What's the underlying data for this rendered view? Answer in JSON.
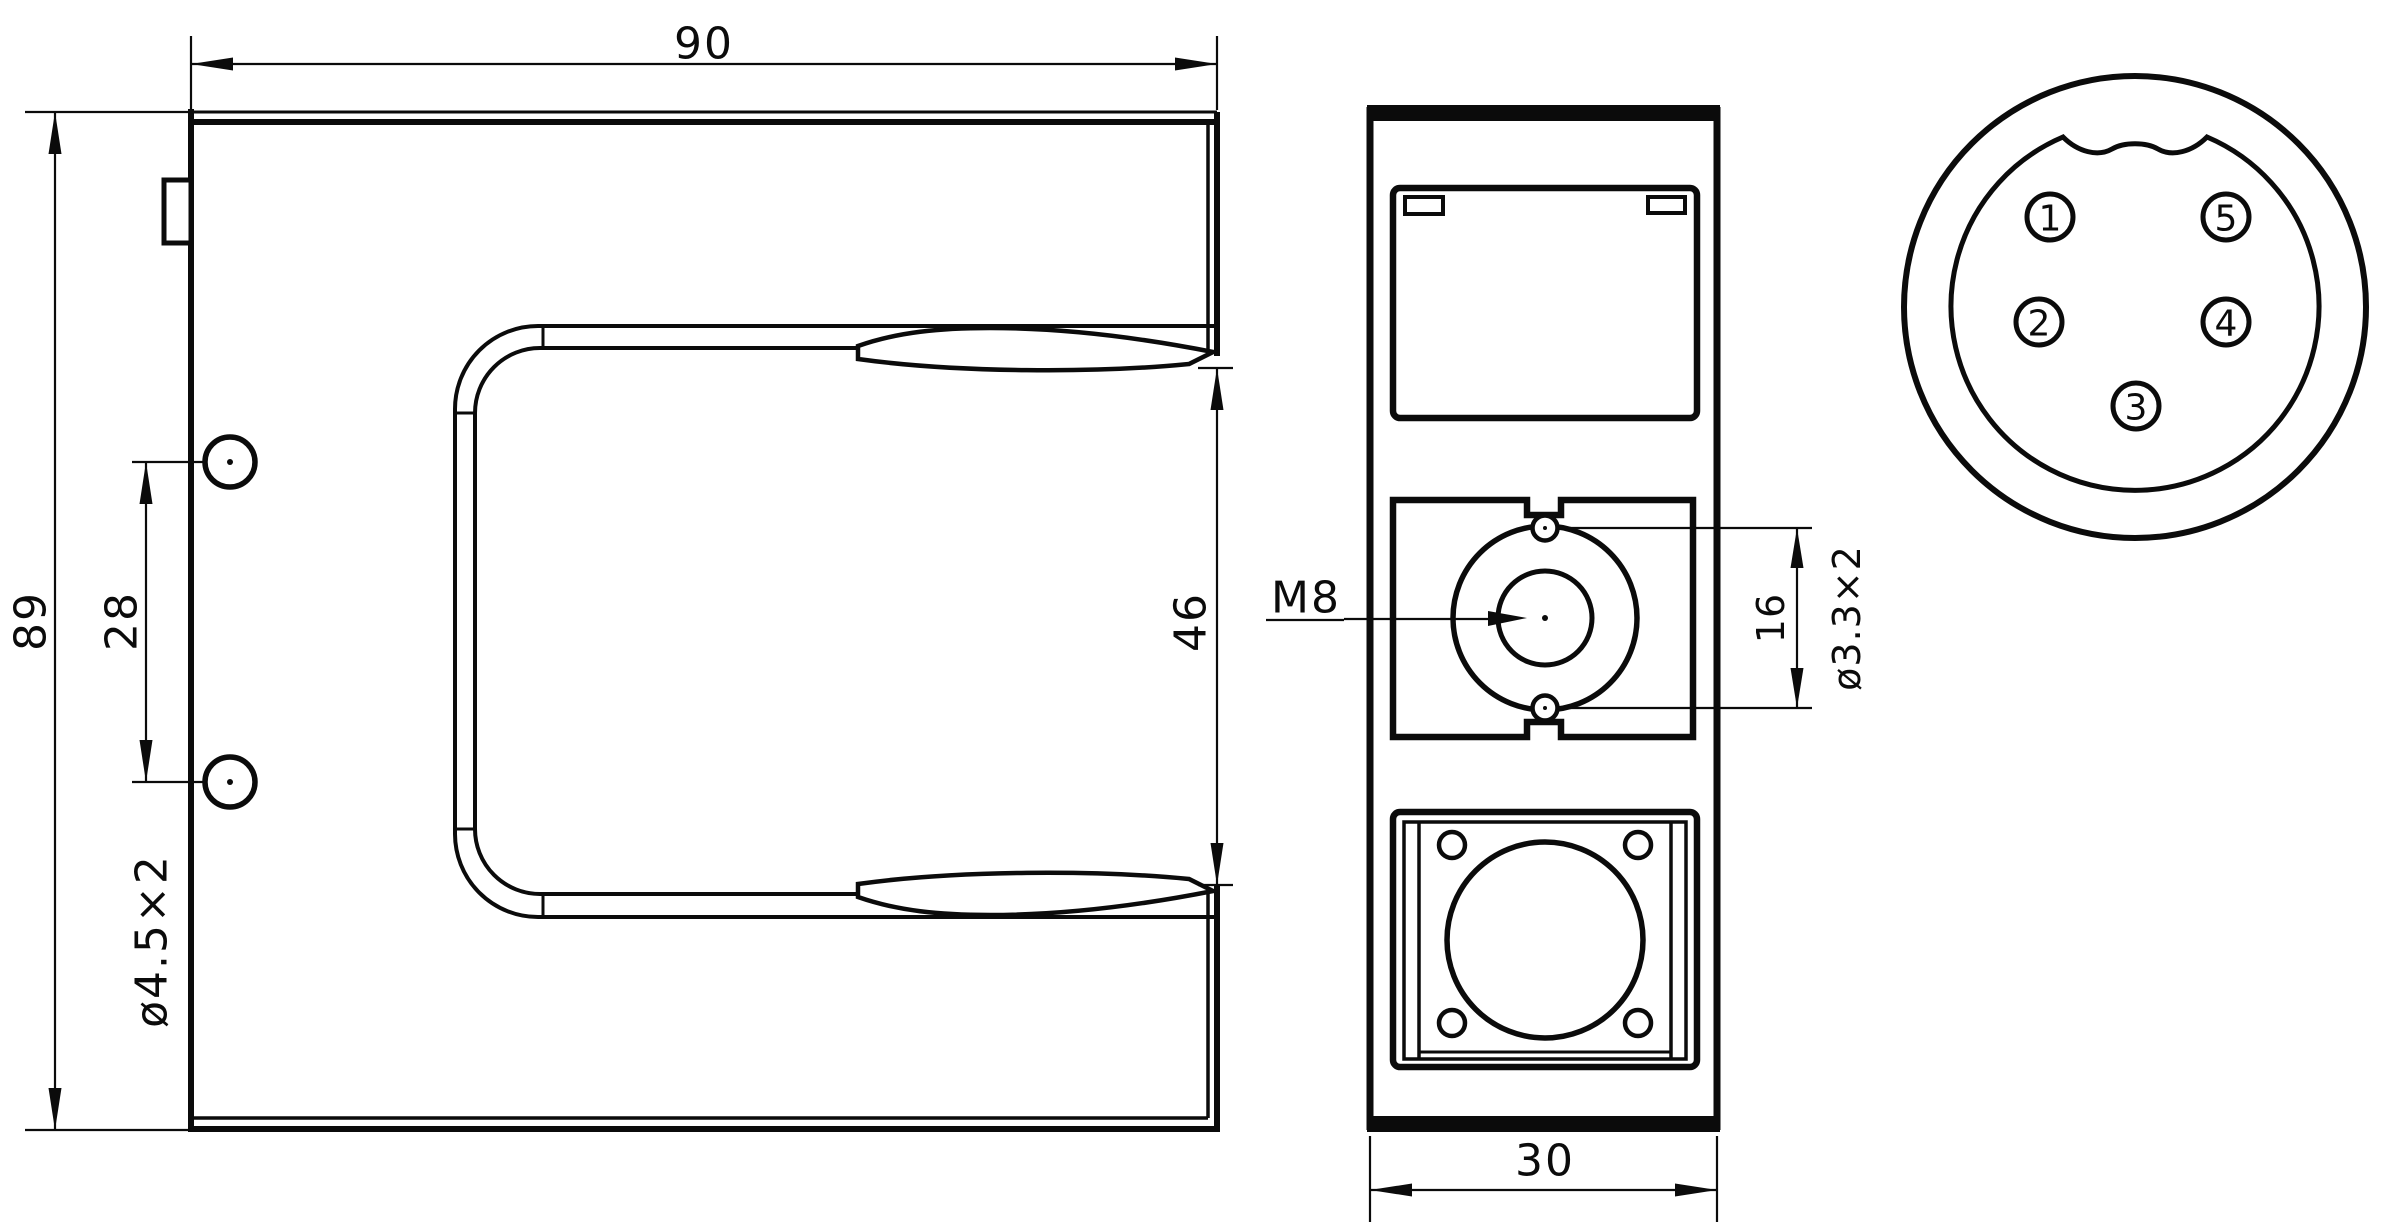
{
  "colors": {
    "line": "#0b0b0b",
    "background": "#ffffff"
  },
  "front_view": {
    "width_dim": "90",
    "height_dim": "89",
    "hole_spacing_dim": "28",
    "hole_note": "ø4.5×2",
    "slot_width_dim": "46"
  },
  "side_view": {
    "thread_label": "M8",
    "hole_spacing_dim": "16",
    "hole_note": "ø3.3×2",
    "depth_dim": "30"
  },
  "connector": {
    "pins": [
      "1",
      "2",
      "3",
      "4",
      "5"
    ]
  }
}
